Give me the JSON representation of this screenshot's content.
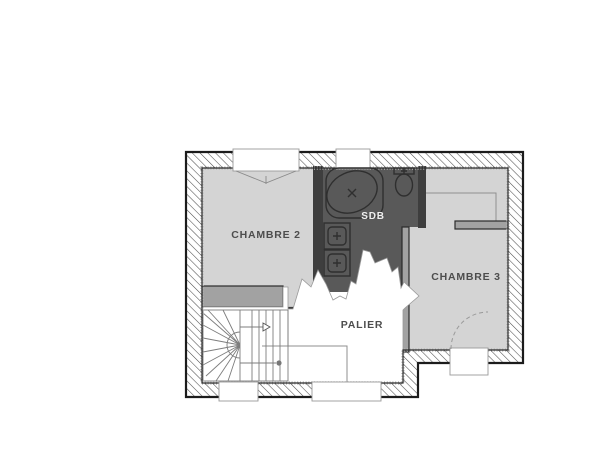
{
  "rooms": {
    "chambre2": {
      "label": "CHAMBRE 2"
    },
    "sdb": {
      "label": "SDB"
    },
    "chambre3": {
      "label": "CHAMBRE 3"
    },
    "palier": {
      "label": "PALIER"
    }
  },
  "palette": {
    "floor": "#d4d4d4",
    "wet": "#595959",
    "wallline": "#2b2b2b",
    "iwall": "#a2a2a2",
    "label": "#4d4d4d",
    "labellight": "#efefef",
    "fixture": "#2f2f2f"
  }
}
